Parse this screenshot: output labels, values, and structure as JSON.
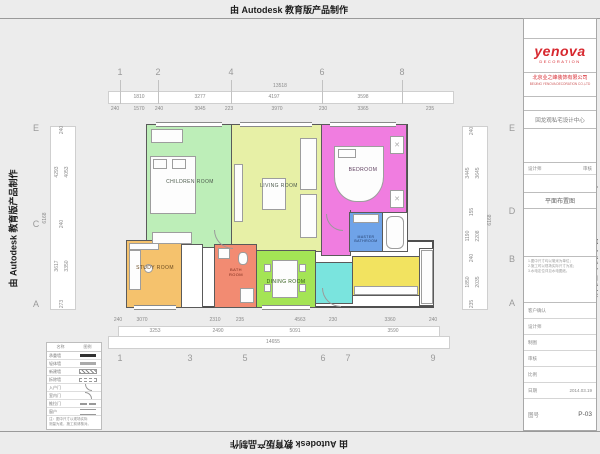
{
  "watermarks": {
    "top": "由 Autodesk 教育版产品制作",
    "bottom": "由 Autodesk 教育版产品制作",
    "left": "由 Autodesk 教育版产品制作",
    "right": "由 Autodesk 教育版产品制作"
  },
  "grid": {
    "top": [
      "1",
      "2",
      "4",
      "6",
      "8"
    ],
    "bottom": [
      "1",
      "3",
      "5",
      "6",
      "7",
      "9"
    ],
    "left": [
      "E",
      "C",
      "A"
    ],
    "right": [
      "E",
      "D",
      "B",
      "A"
    ]
  },
  "dims": {
    "top_total": "13518",
    "top_row": [
      "1810",
      "3277",
      "4197",
      "3598"
    ],
    "top_sub": [
      "240",
      "1570",
      "240",
      "3045",
      "223",
      "3970",
      "230",
      "3365",
      "235"
    ],
    "bottom_sub": [
      "240",
      "3070",
      "2310",
      "235",
      "4563",
      "230",
      "3360",
      "240"
    ],
    "bottom_row": [
      "3253",
      "2490",
      "5091",
      "3590"
    ],
    "bottom_total": "14655",
    "left_outer": "6168",
    "left_sub_top": "240",
    "left_pair1a": "4293",
    "left_pair1b": "4053",
    "left_sub_mid": "240",
    "left_pair2a": "3617",
    "left_pair2b": "3350",
    "left_sub_bot": "273",
    "right_sub_top": "240",
    "right_pair1a": "3445",
    "right_pair1b": "3645",
    "right_mid": "155",
    "right_pair2a": "1190",
    "right_pair2b": "2208",
    "right_outer": "6168",
    "right_sub_mid": "240",
    "right_pair3a": "1850",
    "right_pair3b": "2035",
    "right_sub_bot": "235"
  },
  "rooms": {
    "children": {
      "label": "CHILDREN ROOM",
      "color": "#bdeeb8"
    },
    "living": {
      "label": "LIVING ROOM",
      "color": "#e7f0a6"
    },
    "bedroom": {
      "label": "BEDROOM",
      "color": "#f07de0"
    },
    "master_bath": {
      "label": "MASTER BATHROOM",
      "color": "#6fa3e8"
    },
    "study": {
      "label": "STUDY ROOM",
      "color": "#f5c26d"
    },
    "bath": {
      "label": "BATH ROOM",
      "color": "#f28b72"
    },
    "dining": {
      "label": "DINING ROOM",
      "color": "#a4e455"
    },
    "entry": {
      "label": "",
      "color": "#7ae4de"
    },
    "kitchen": {
      "label": "",
      "color": "#f2e360"
    }
  },
  "legend": {
    "header": [
      "名称",
      "图例"
    ],
    "rows": [
      {
        "name": "承重墙"
      },
      {
        "name": "轻体墙"
      },
      {
        "name": "新建墙"
      },
      {
        "name": "拆除墙"
      },
      {
        "name": "入户门"
      },
      {
        "name": "室内门"
      },
      {
        "name": "推拉门"
      },
      {
        "name": "窗户"
      }
    ],
    "note1": "注：图中尺寸以现场实际",
    "note2": "测量为准，施工前请核对。"
  },
  "titleblock": {
    "brand_color": "#d7282f",
    "logo": "yenova",
    "logo_sub": "DECORATION",
    "company": "北京业之峰装饰有限公司",
    "company_sub": "BEIJING YENOVA DECORATION CO.,LTD",
    "project": "回龙观私宅设计中心",
    "designer_label": "设计师",
    "check_label": "审核",
    "drawing_name": "平面布置图",
    "note_line1": "1.图中尺寸均以毫米为单位；",
    "note_line2": "2.施工时以现场实际尺寸为准；",
    "note_line3": "3.水电定位详见水电图纸。",
    "fields": [
      {
        "label": "客户确认",
        "value": ""
      },
      {
        "label": "设计师",
        "value": ""
      },
      {
        "label": "制图",
        "value": ""
      },
      {
        "label": "审核",
        "value": ""
      },
      {
        "label": "比例",
        "value": ""
      },
      {
        "label": "日期",
        "value": "2014.03.19"
      }
    ],
    "sheet_label": "图号",
    "sheet_no": "P-03"
  }
}
